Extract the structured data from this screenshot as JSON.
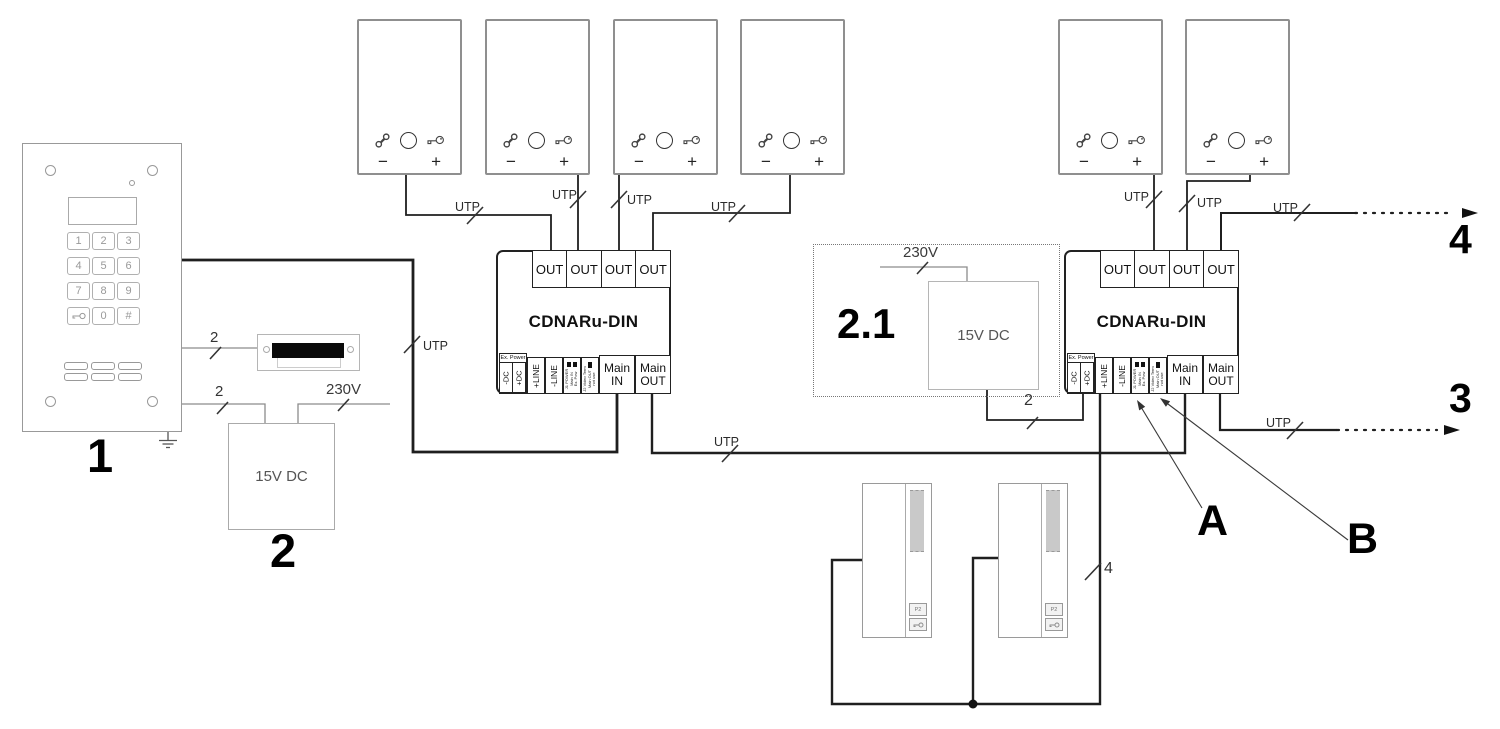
{
  "labels": {
    "utp": "UTP",
    "wire_two": "2",
    "wire_four": "4",
    "mains_230v": "230V"
  },
  "callouts": {
    "door_panel": "1",
    "power_supply": "2",
    "extra_power_supply": "2.1",
    "jumper_a": "A",
    "jumper_b": "B",
    "riser_continue_top": "4",
    "riser_continue_bottom": "3"
  },
  "power_supply": {
    "label": "15V DC"
  },
  "module": {
    "name": "CDNARu-DIN",
    "out_terminal": "OUT",
    "ex_power": "Ex. Power",
    "neg_dc": "-DC",
    "pos_dc": "+DC",
    "pos_line": "+LINE",
    "neg_line": "-LINE",
    "jumper1": {
      "line1": "J1 POWER",
      "line2": "Main IN",
      "line3": "Ex. Pow"
    },
    "jumper2": {
      "line1": "J2 Video Term",
      "line2": "Main OUT",
      "line3": "not use"
    },
    "main": "Main",
    "main_in": "IN",
    "main_out": "OUT"
  },
  "door_panel": {
    "keys": [
      "1",
      "2",
      "3",
      "4",
      "5",
      "6",
      "7",
      "8",
      "9",
      "0",
      "#"
    ]
  },
  "uniphone": {
    "volume_minus": "−",
    "volume_plus": "+"
  },
  "monitor": {
    "function_button": "P2"
  }
}
